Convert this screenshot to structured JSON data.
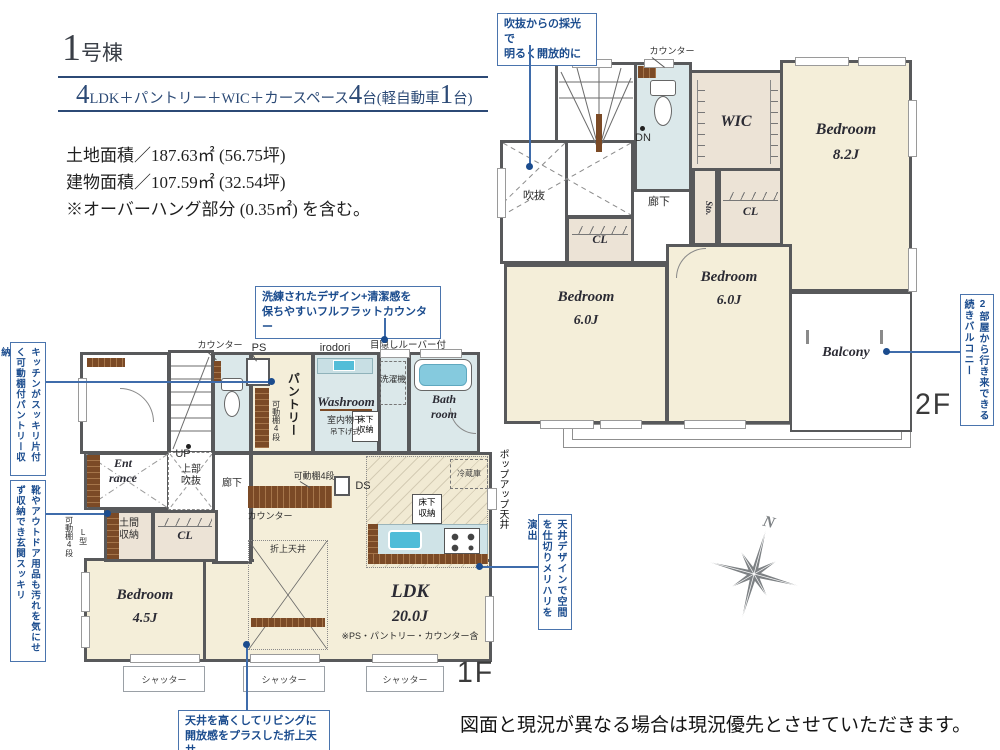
{
  "header": {
    "building_number": "1",
    "building_suffix": "号棟",
    "spec": {
      "big1": "4",
      "mid1": "LDK＋パントリー＋WIC＋カースペース",
      "big2": "4",
      "mid2": "台(軽自動車",
      "big3": "1",
      "mid3": "台)"
    },
    "areas": {
      "land": "土地面積／187.63㎡ (56.75坪)",
      "building": "建物面積／107.59㎡ (32.54坪)",
      "note": "※オーバーハング部分 (0.35㎡) を含む。"
    }
  },
  "callouts": {
    "atrium_light": {
      "line1": "吹抜からの採光で",
      "line2": "明るく開放的に"
    },
    "pantry_storage": "キッチンがスッキリ片付く可動棚付パントリー収納",
    "entrance_storage": "靴やアウトドア用品も汚れを気にせず収納でき玄関スッキリ",
    "flat_counter": {
      "line1": "洗練されたデザイン+清潔感を",
      "line2": "保ちやすいフルフラットカウンター"
    },
    "balcony": "2部屋から行き来できる続きバルコニー",
    "ceiling_design": "天井デザインで空間を仕切りメリハリを演出",
    "coffered_ceiling": {
      "line1": "天井を高くしてリビングに",
      "line2": "開放感をプラスした折上天井"
    }
  },
  "floor2": {
    "label": "2F",
    "counter": "カウンター",
    "dn": "DN",
    "wic": "WIC",
    "hallway": "廊下",
    "sto": "Sto.",
    "cl": "CL",
    "atrium": "吹抜",
    "bedroom_main": {
      "name": "Bedroom",
      "size": "8.2J"
    },
    "bedroom_left": {
      "name": "Bedroom",
      "size": "6.0J"
    },
    "bedroom_mid": {
      "name": "Bedroom",
      "size": "6.0J"
    },
    "balcony": "Balcony"
  },
  "floor1": {
    "label": "1F",
    "counter_top": "カウンター",
    "ps": "PS",
    "pantry": "パントリー",
    "shelf4_pantry": "可動棚4段",
    "open_sanitary": "オープンサニタリー",
    "irodori": "irodori",
    "louver": "目隠しルーバー付",
    "washer": "洗濯機",
    "washroom": "Washroom",
    "indoor_drying": "室内物干",
    "hanging_type": "吊下げ式",
    "underfloor1": {
      "line1": "床下",
      "line2": "収納"
    },
    "bathroom": {
      "line1": "Bath",
      "line2": "room"
    },
    "entrance": {
      "line1": "Ent",
      "line2": "rance"
    },
    "up": "UP",
    "upper_void": {
      "line1": "上部",
      "line2": "吹抜"
    },
    "hallway": "廊下",
    "doma": {
      "line1": "土間",
      "line2": "収納"
    },
    "l_type": "L型",
    "shelf4_entrance": "可動棚4段",
    "cl": "CL",
    "counter_ldk": "カウンター",
    "shelf4_ldk": "可動棚4段",
    "ds": "DS",
    "fridge": "冷蔵庫",
    "underfloor2": {
      "line1": "床下",
      "line2": "収納"
    },
    "popup_ceiling": "ポップアップ天井",
    "coffered": "折上天井",
    "bedroom": {
      "name": "Bedroom",
      "size": "4.5J"
    },
    "ldk": {
      "name": "LDK",
      "size": "20.0J",
      "note": "※PS・パントリー・カウンター含"
    },
    "shutter": "シャッター"
  },
  "compass": {
    "north": "N"
  },
  "footer": {
    "disclaimer": "図面と現況が異なる場合は現況優先とさせていただきます。"
  },
  "colors": {
    "accent_blue": "#3f6cab",
    "callout_text": "#1b4c8e",
    "wall": "#58595b",
    "room_beige": "#f4eed9",
    "closet_beige": "#ece3d6",
    "wet_blue": "#dbe8ea",
    "wood_brown": "#7b4a26"
  }
}
